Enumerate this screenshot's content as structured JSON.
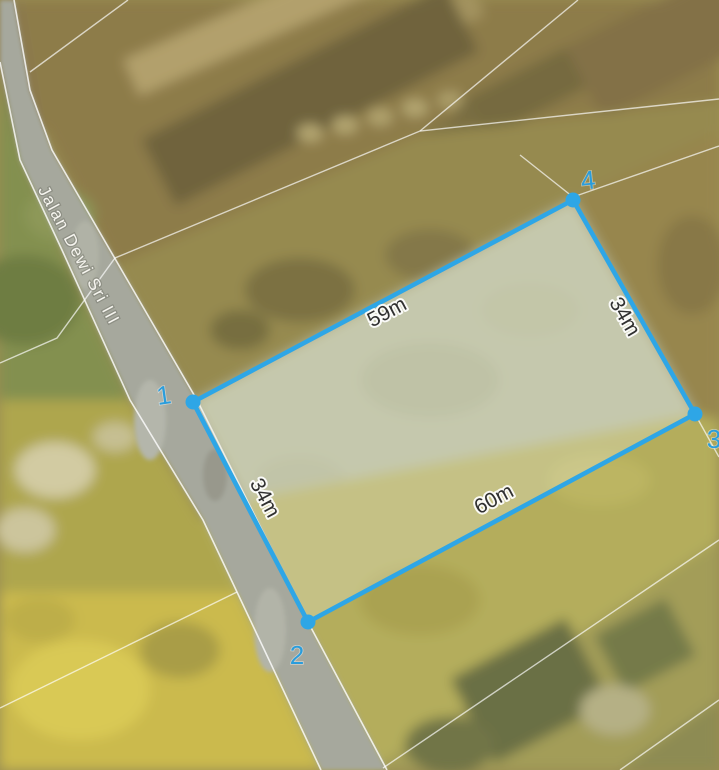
{
  "map": {
    "road_label": "Jalan Dewi Sri III",
    "parcel": {
      "vertex_labels": {
        "v1": "1",
        "v2": "2",
        "v3": "3",
        "v4": "4"
      },
      "measurements": {
        "top": "59m",
        "right": "34m",
        "bottom": "60m",
        "left": "34m"
      }
    },
    "colors": {
      "selection_blue": "#2ea6e6",
      "vertex_number_blue": "#2a9ddc",
      "measurement_text": "#303030",
      "street_label_text": "#f6f5ef",
      "road_fill": "#a6a89d",
      "cadastral_line": "#ffffff",
      "terrain_brown": "#8d7b4a",
      "terrain_olive": "#968a50",
      "terrain_green": "#839050",
      "terrain_yellow": "#cbba4e",
      "parcel_fill_tint": "#b4b795"
    }
  }
}
